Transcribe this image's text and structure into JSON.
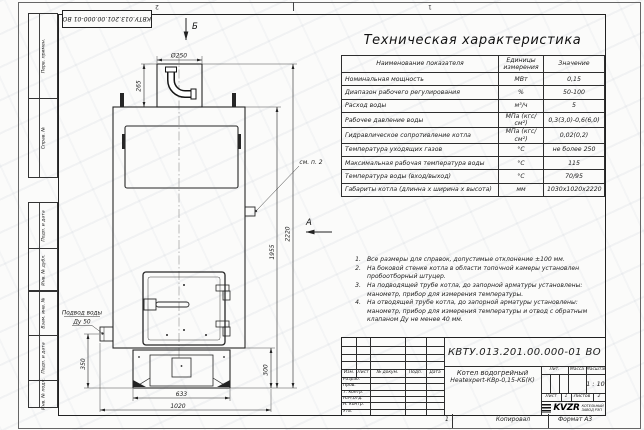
{
  "frame": {
    "doc_number_stamp": "КВТУ.013.201.00.000-01 ВО",
    "left_margin_labels": [
      "Перв. примен.",
      "Справ. №",
      "Подп. и дата",
      "Инв. № дубл.",
      "Взам. инв. №",
      "Подп. и дата",
      "Инв. № подл."
    ],
    "top_zone_marks": [
      "2",
      "1"
    ],
    "bottom": {
      "zone_mark": "1",
      "copied_label": "Копировал",
      "format_label": "Формат А3"
    }
  },
  "drawing": {
    "view_labels": {
      "top_view_arrow": "Б",
      "side_view_arrow": "А",
      "note_ref": "см. п. 2"
    },
    "callouts": {
      "water_inlet_line1": "Подвод воды",
      "water_inlet_line2": "Ду 50"
    },
    "dimensions": {
      "chimney_diameter": "Ø250",
      "chimney_height": "265",
      "body_height": "1955",
      "total_height": "2220",
      "inlet_height": "350",
      "base_height": "300",
      "base_width": "633",
      "total_width": "1020"
    }
  },
  "spec_table": {
    "title": "Техническая характеристика",
    "headers": [
      "Наименование показателя",
      "Единицы измерения",
      "Значение"
    ],
    "rows": [
      [
        "Номинальная мощность",
        "МВт",
        "0,15"
      ],
      [
        "Диапазон рабочего регулирования",
        "%",
        "50-100"
      ],
      [
        "Расход воды",
        "м³/ч",
        "5"
      ],
      [
        "Рабочее давление воды",
        "МПа (кгс/см²)",
        "0,3(3,0)-0,6(6,0)"
      ],
      [
        "Гидравлическое сопротивление котла",
        "МПа (кгс/см²)",
        "0,02(0,2)"
      ],
      [
        "Температура уходящих газов",
        "°С",
        "не более 250"
      ],
      [
        "Максимальная рабочая температура воды",
        "°С",
        "115"
      ],
      [
        "Температура воды (вход/выход)",
        "°С",
        "70/95"
      ],
      [
        "Габариты котла (длинна х ширина х высота)",
        "мм",
        "1030х1020х2220"
      ]
    ]
  },
  "notes": [
    {
      "n": "1.",
      "text": "Все размеры для справок, допустимые отклонение ±100 мм."
    },
    {
      "n": "2.",
      "text": "На боковой стенке котла в области топочной камеры установлен пробоотборный штуцер."
    },
    {
      "n": "3.",
      "text": "На подводящей трубе котла, до запорной арматуры установлены: манометр, прибор для измерения температуры."
    },
    {
      "n": "4.",
      "text": "На отводящей трубе котла, до запорной арматуры установлены: манометр, прибор для измерения температуры и отвод с обратным клапаном Ду не менее 40 мм."
    }
  ],
  "title_block": {
    "doc_number": "КВТУ.013.201.00.000-01 ВО",
    "product_name_line1": "Котел водогрейный",
    "product_name_line2": "Heatexpert-КВр-0,15-КБ(К)",
    "col_headers": {
      "lit": "Лит.",
      "mass": "Масса",
      "scale": "Масштаб"
    },
    "scale_value": "1 : 10",
    "sheet_label": "Лист",
    "sheet_value": "1",
    "sheets_label": "Листов",
    "sheets_value": "2",
    "company": {
      "logo": "KVZR",
      "name_line1": "КОТЕЛЬНЫЙ",
      "name_line2": "ЗАВОД РЭП"
    },
    "rev_headers": [
      "Изм.",
      "Лист",
      "№ докум.",
      "Подп.",
      "Дата"
    ],
    "role_rows": [
      "Разраб.",
      "Пров.",
      "Т. контр.",
      "Нач.отд.",
      "Н. контр.",
      "Утв."
    ]
  }
}
